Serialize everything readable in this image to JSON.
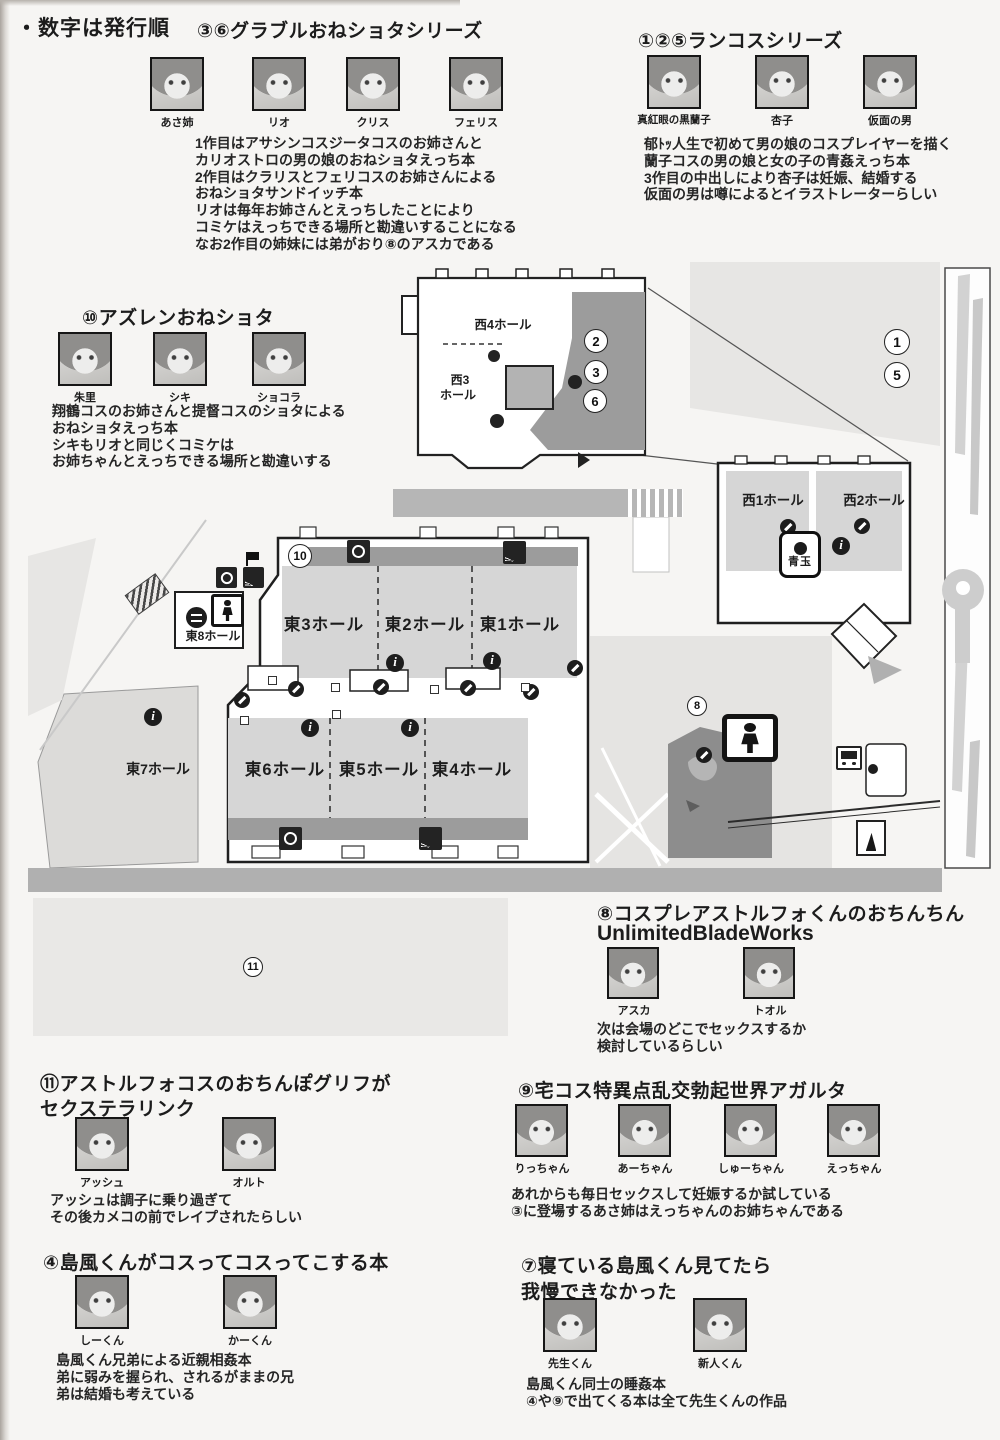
{
  "page": {
    "note": "・数字は発行順"
  },
  "colors": {
    "page_bg": "#f6f5f3",
    "hall_fill": "#d6d6d6",
    "shaded_zone": "#9c9c9c",
    "road": "#b6b6b6"
  },
  "sections": {
    "granblue": {
      "title": "③⑥グラブルおねショタシリーズ",
      "characters": [
        "あさ姉",
        "リオ",
        "クリス",
        "フェリス"
      ],
      "desc": [
        "1作目はアサシンコスジータコスのお姉さんと",
        "カリオストロの男の娘のおねショタえっち本",
        "2作目はクラリスとフェリコスのお姉さんによる",
        "おねショタサンドイッチ本",
        "リオは毎年お姉さんとえっちしたことにより",
        "コミケはえっちできる場所と勘違いすることになる",
        "なお2作目の姉妹には弟がおり⑧のアスカである"
      ]
    },
    "rancos": {
      "title": "①②⑤ランコスシリーズ",
      "characters": [
        "真紅眼の黒蘭子",
        "杏子",
        "仮面の男"
      ],
      "desc": [
        "郁ﾄｯ人生で初めて男の娘のコスプレイヤーを描く",
        "蘭子コスの男の娘と女の子の青姦えっち本",
        "3作目の中出しにより杏子は妊娠、結婚する",
        "仮面の男は噂によるとイラストレーターらしい"
      ]
    },
    "azurlane": {
      "title": "⑩アズレンおねショタ",
      "characters": [
        "朱里",
        "シキ",
        "ショコラ"
      ],
      "desc": [
        "翔鶴コスのお姉さんと提督コスのショタによる",
        "おねショタえっち本",
        "シキもリオと同じくコミケは",
        "お姉ちゃんとえっちできる場所と勘違いする"
      ]
    },
    "astolfo8": {
      "title": "⑧コスプレアストルフォくんのおちんちん",
      "title2": "UnlimitedBladeWorks",
      "characters": [
        "アスカ",
        "トオル"
      ],
      "desc": [
        "次は会場のどこでセックスするか",
        "検討しているらしい"
      ]
    },
    "astolfo11": {
      "title": "⑪アストルフォコスのおちんぽグリフが",
      "title2": "セクステラリンク",
      "characters": [
        "アッシュ",
        "オルト"
      ],
      "desc": [
        "アッシュは調子に乗り過ぎて",
        "その後カメコの前でレイプされたらしい"
      ]
    },
    "agartha9": {
      "title": "⑨宅コス特異点乱交勃起世界アガルタ",
      "characters": [
        "りっちゃん",
        "あーちゃん",
        "しゅーちゃん",
        "えっちゃん"
      ],
      "desc": [
        "あれからも毎日セックスして妊娠するか試している",
        "③に登場するあさ姉はえっちゃんのお姉ちゃんである"
      ]
    },
    "shimakaze4": {
      "title": "④島風くんがコスってコスってこする本",
      "characters": [
        "しーくん",
        "かーくん"
      ],
      "desc": [
        "島風くん兄弟による近親相姦本",
        "弟に弱みを握られ、されるがままの兄",
        "弟は結婚も考えている"
      ]
    },
    "shimakaze7": {
      "title": "⑦寝ている島風くん見てたら",
      "title2": "我慢できなかった",
      "characters": [
        "先生くん",
        "新人くん"
      ],
      "desc": [
        "島風くん同士の睡姦本",
        "④や⑨で出てくる本は全て先生くんの作品"
      ]
    }
  },
  "map": {
    "inset": {
      "hall_w4": "西4ホール",
      "hall_w3a": "西3",
      "hall_w3b": "ホール"
    },
    "west": {
      "hall_w1": "西1ホール",
      "hall_w2": "西2ホール",
      "badge": "青玉"
    },
    "east": {
      "e1": "東1ホール",
      "e2": "東2ホール",
      "e3": "東3ホール",
      "e4": "東4ホール",
      "e5": "東5ホール",
      "e6": "東6ホール",
      "e7": "東7ホール",
      "e8": "東8ホール"
    },
    "markers": {
      "m1": "1",
      "m2": "2",
      "m3": "3",
      "m5": "5",
      "m6": "6",
      "m8": "8",
      "m10": "10",
      "m11": "11"
    }
  }
}
